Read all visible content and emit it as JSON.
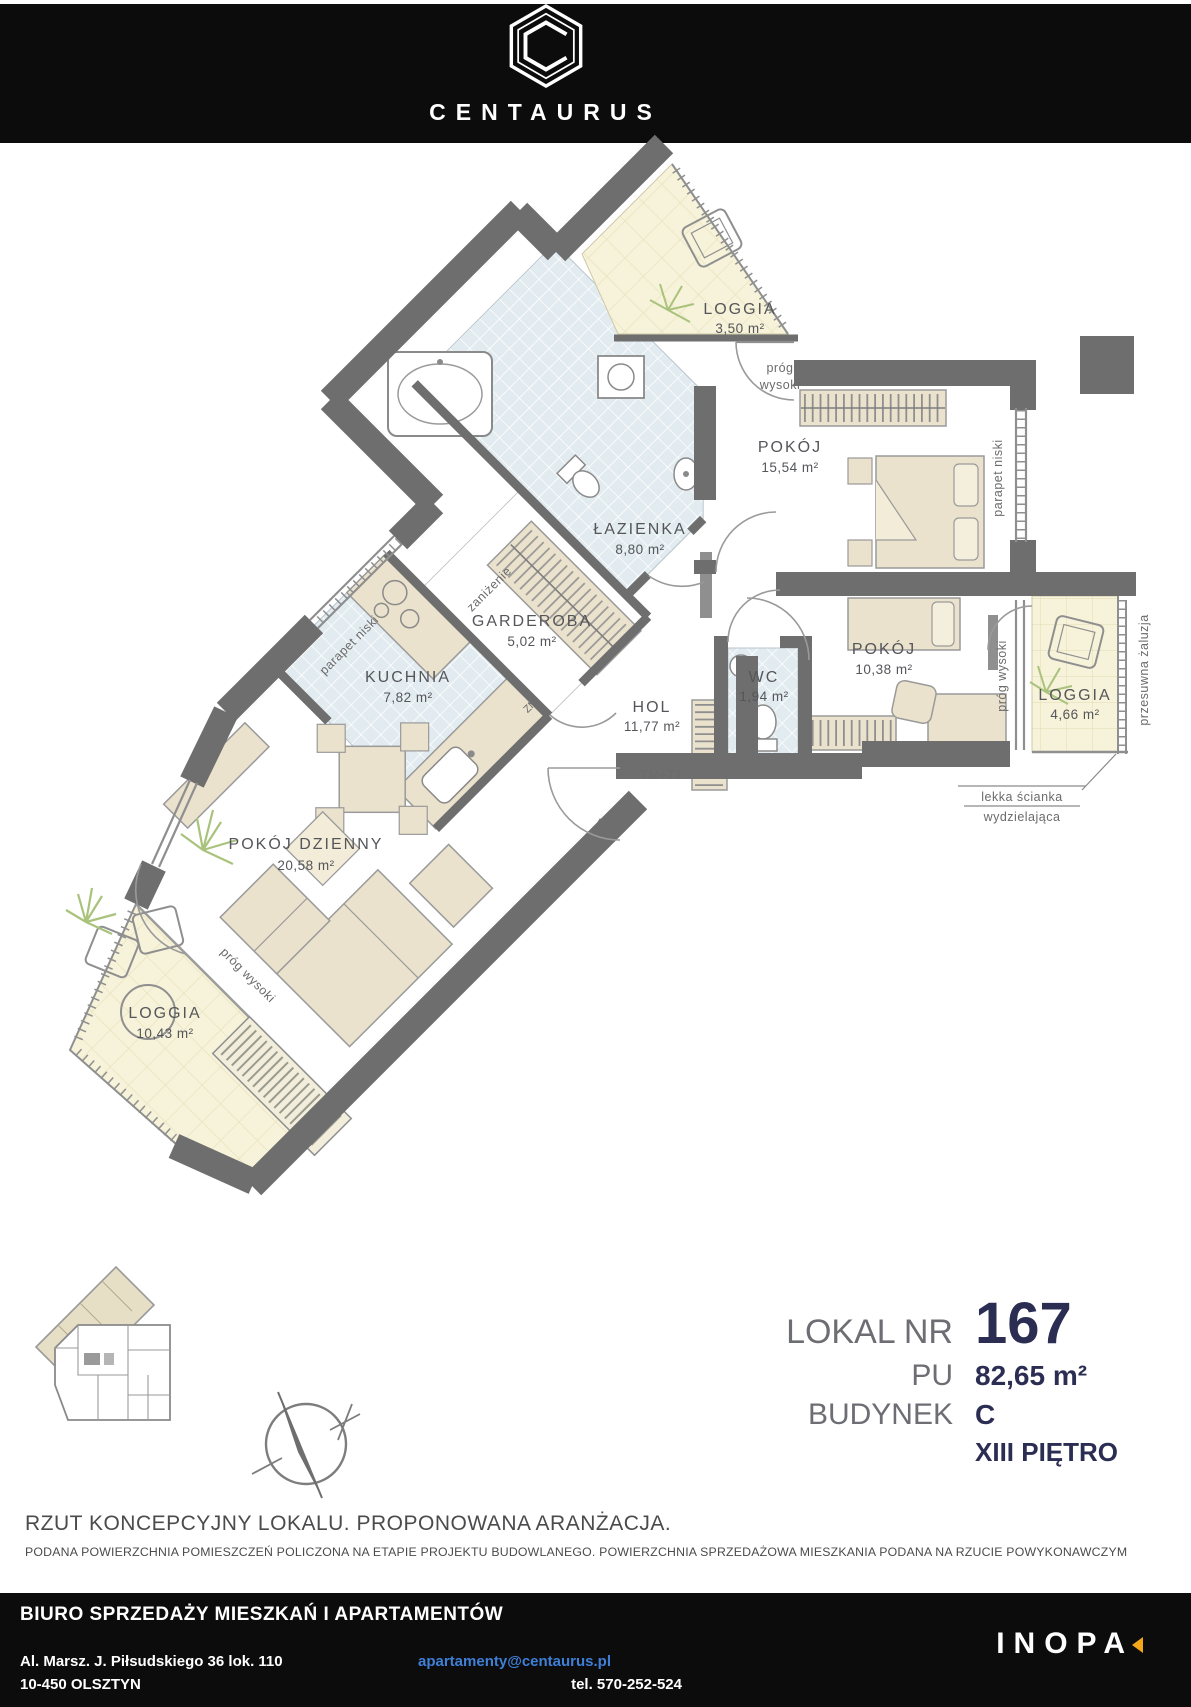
{
  "header": {
    "brand": "CENTAURUS"
  },
  "rooms": [
    {
      "name": "LOGGIA",
      "area": "3,50 m²"
    },
    {
      "name": "POKÓJ",
      "area": "15,54 m²"
    },
    {
      "name": "ŁAZIENKA",
      "area": "8,80 m²"
    },
    {
      "name": "GARDEROBA",
      "area": "5,02 m²"
    },
    {
      "name": "KUCHNIA",
      "area": "7,82 m²"
    },
    {
      "name": "POKÓJ",
      "area": "10,38 m²"
    },
    {
      "name": "WC",
      "area": "1,94 m²"
    },
    {
      "name": "HOL",
      "area": "11,77 m²"
    },
    {
      "name": "LOGGIA",
      "area": "4,66 m²"
    },
    {
      "name": "POKÓJ DZIENNY",
      "area": "20,58 m²"
    },
    {
      "name": "LOGGIA",
      "area": "10,43 m²"
    }
  ],
  "annotations": {
    "prog": "próg",
    "wysoki": "wysoki",
    "prog_wysoki": "próg wysoki",
    "parapet_niski": "parapet niski",
    "przesuwna_zaluzja": "przesuwna żaluzja",
    "zanizenie": "zaniżenie",
    "lekka_scianka": "lekka ścianka",
    "wydzielajaca": "wydzielająca",
    "tm": "TM+TT",
    "zm": "ZM"
  },
  "info": {
    "lokal_label": "LOKAL NR",
    "lokal_value": "167",
    "pu_label": "PU",
    "pu_value": "82,65 m²",
    "budynek_label": "BUDYNEK",
    "budynek_value": "C",
    "pietro_value": "XIII PIĘTRO"
  },
  "notes": {
    "title": "RZUT KONCEPCYJNY LOKALU. PROPONOWANA ARANŻACJA.",
    "subtitle": "PODANA POWIERZCHNIA POMIESZCZEŃ POLICZONA NA ETAPIE PROJEKTU BUDOWLANEGO. POWIERZCHNIA SPRZEDAŻOWA MIESZKANIA PODANA NA RZUCIE POWYKONAWCZYM"
  },
  "footer": {
    "office": "BIURO SPRZEDAŻY MIESZKAŃ I APARTAMENTÓW",
    "address1": "Al. Marsz. J. Piłsudskiego 36 lok. 110",
    "address2": "10-450 OLSZTYN",
    "email": "apartamenty@centaurus.pl",
    "phone": "tel. 570-252-524",
    "logo": "INOPA"
  },
  "colors": {
    "wall": "#6e6e6e",
    "loggia_fill": "#f7f3da",
    "wet_fill": "#e1ebf0",
    "furniture": "#eae2cc",
    "navy": "#2b2d52",
    "label_gray": "#6d6d74",
    "email_blue": "#3f7fd6",
    "inopa_orange": "#f2a71b"
  }
}
